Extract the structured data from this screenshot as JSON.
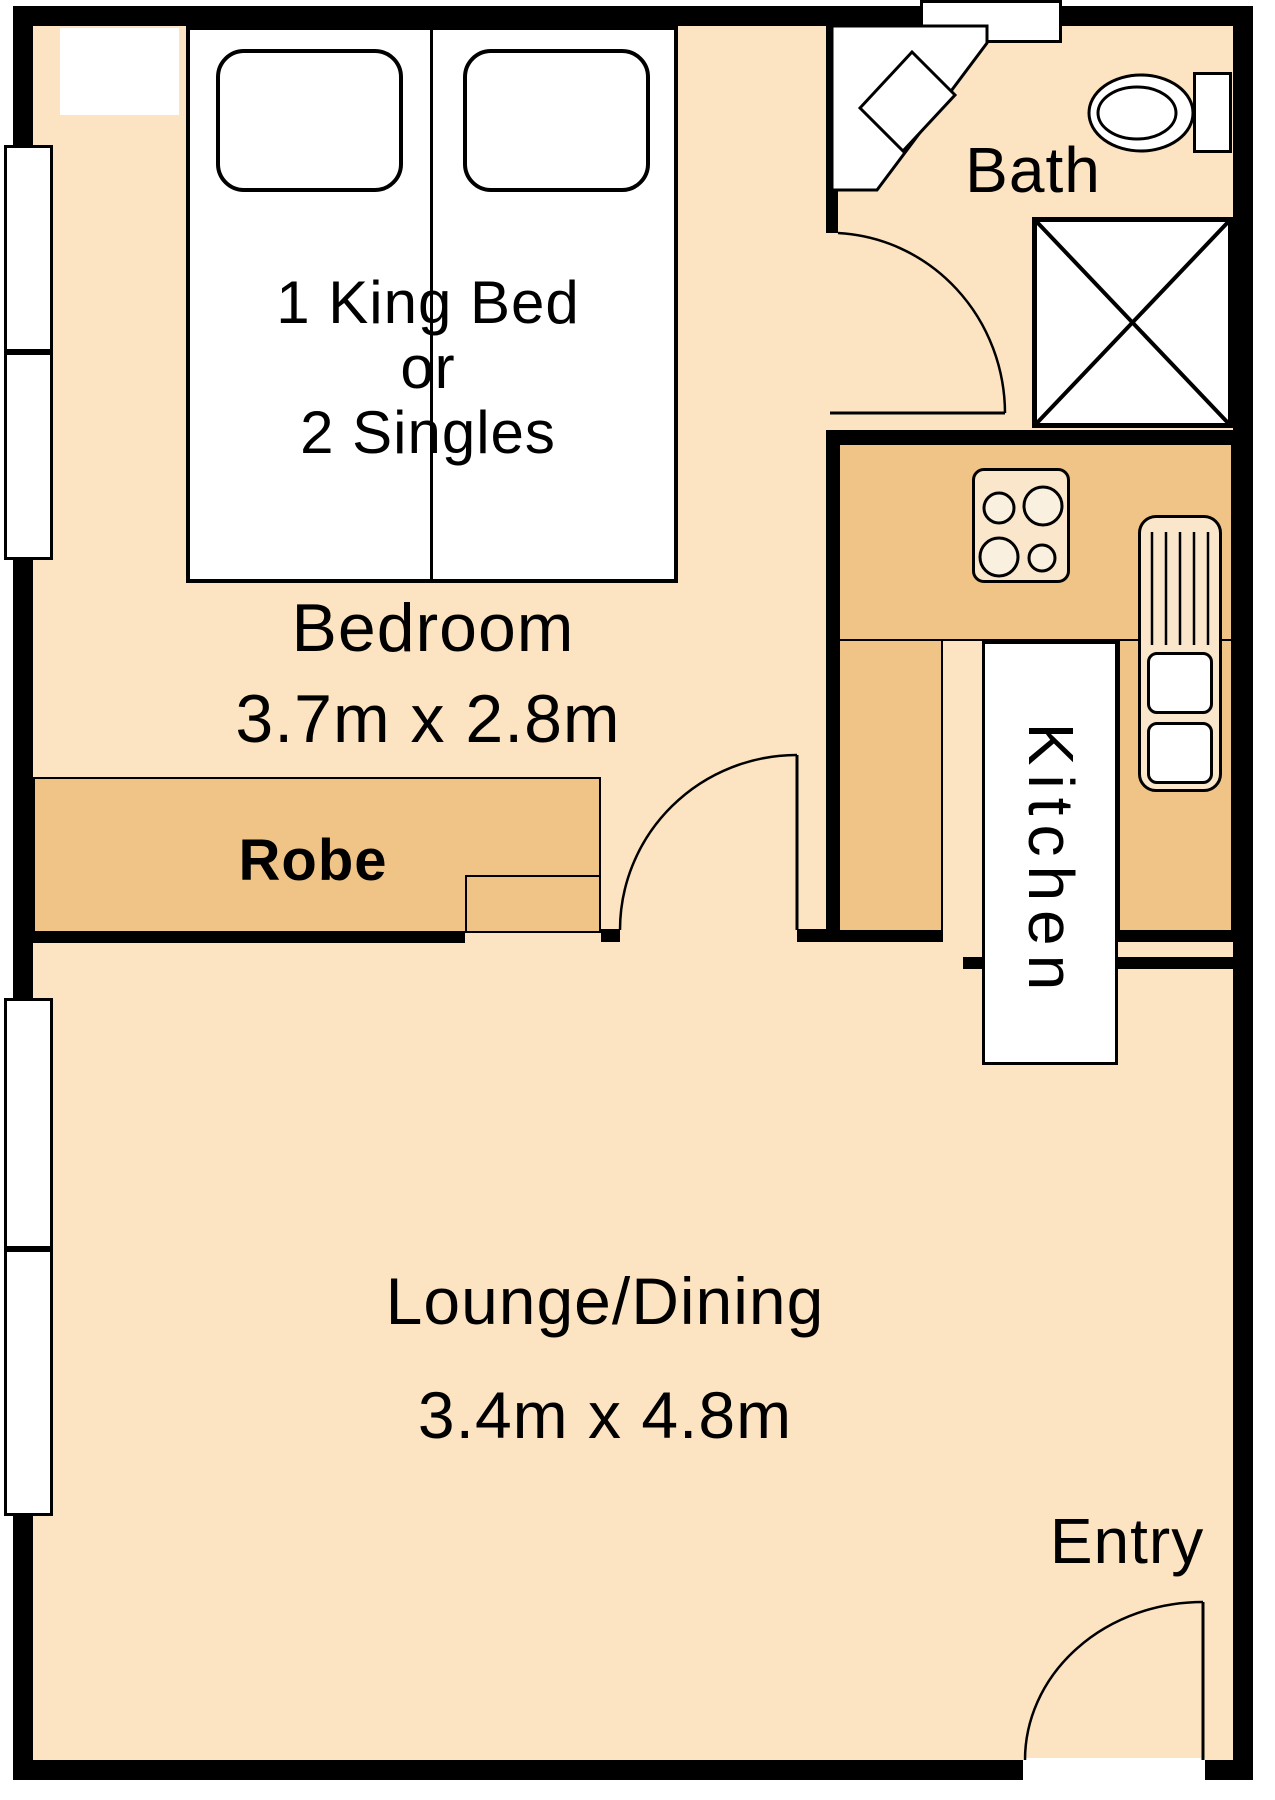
{
  "plan": {
    "rooms": {
      "bedroom": {
        "label": "Bedroom",
        "dimensions": "3.7m x 2.8m"
      },
      "bed": {
        "line1": "1 King Bed",
        "line2": "or",
        "line3": "2 Singles"
      },
      "robe": {
        "label": "Robe"
      },
      "bath": {
        "label": "Bath"
      },
      "kitchen": {
        "label": "Kitchen"
      },
      "lounge": {
        "label": "Lounge/Dining",
        "dimensions": "3.4m x 4.8m"
      },
      "entry": {
        "label": "Entry"
      }
    },
    "colors": {
      "floor": "#fce3c1",
      "cabinet": "#f0c486",
      "wall": "#000000",
      "fixture": "#f9e6cb",
      "burner": "#faf0e0"
    }
  }
}
